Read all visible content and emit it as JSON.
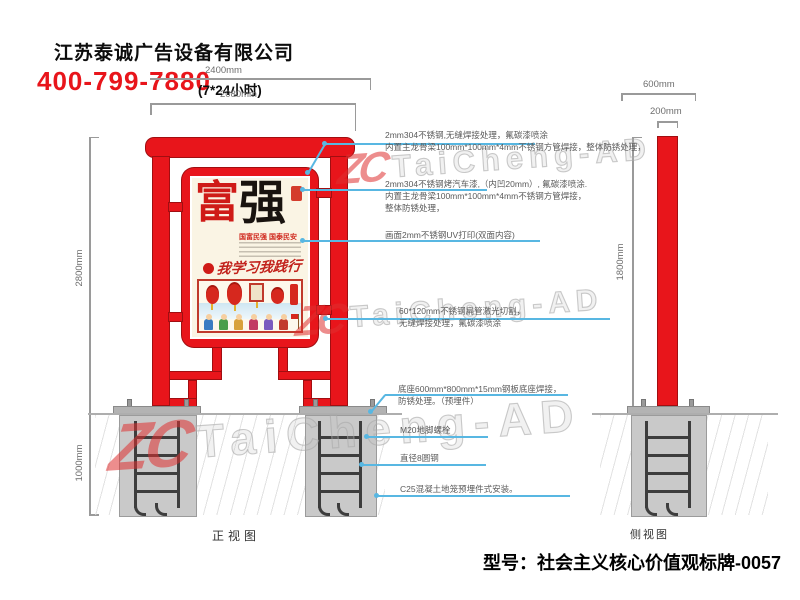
{
  "header": {
    "company": "江苏泰诚广告设备有限公司",
    "phone": "400-799-7880",
    "hours": "(7*24小时)"
  },
  "dimensions": {
    "front_top_outer": "2400mm",
    "front_top_inner": "2080mm",
    "front_height": "2800mm",
    "foundation_depth": "1000mm",
    "side_base_width": "600mm",
    "side_column_depth": "200mm",
    "side_column_height": "1800mm"
  },
  "annotations": [
    {
      "line1": "2mm304不锈钢,无缝焊接处理，氟碳漆喷涂",
      "line2": "内置主龙骨梁100mm*100mm*4mm不锈钢方管焊接，整体防锈处理，"
    },
    {
      "line1": "2mm304不锈钢烤汽车漆,（内凹20mm）, 氟碳漆喷涂.",
      "line2": "内置主龙骨梁100mm*100mm*4mm不锈钢方管焊接，",
      "line3": "整体防锈处理，"
    },
    {
      "line1": "画面2mm不锈钢UV打印(双面内容)"
    },
    {
      "line1": "60*120mm不锈钢扁管激光切割，",
      "line2": "无缝焊接处理，氟碳漆喷涂"
    },
    {
      "line1": "底座600mm*800mm*15mm钢板底座焊接，",
      "line2": "防锈处理。（预埋件）"
    },
    {
      "line1": "M20地脚螺栓"
    },
    {
      "line1": "直径8圆钢"
    },
    {
      "line1": "C25混凝土地笼预埋件式安装。"
    }
  ],
  "poster": {
    "char_left": "富",
    "char_right": "强",
    "subtitle": "国富民强 国泰民安",
    "calligraphy": "我学习我践行"
  },
  "view_labels": {
    "front": "正视图",
    "side": "侧视图"
  },
  "model_label": "型号：社会主义核心价值观标牌-0057",
  "watermark": {
    "logo_text": "ZC",
    "brand_text": "TaiCheng-AD"
  },
  "colors": {
    "sign_red": "#e8151b",
    "phone_red": "#e8151b",
    "leader_blue": "#58b7e2",
    "concrete_gray": "#c9c9c9"
  }
}
